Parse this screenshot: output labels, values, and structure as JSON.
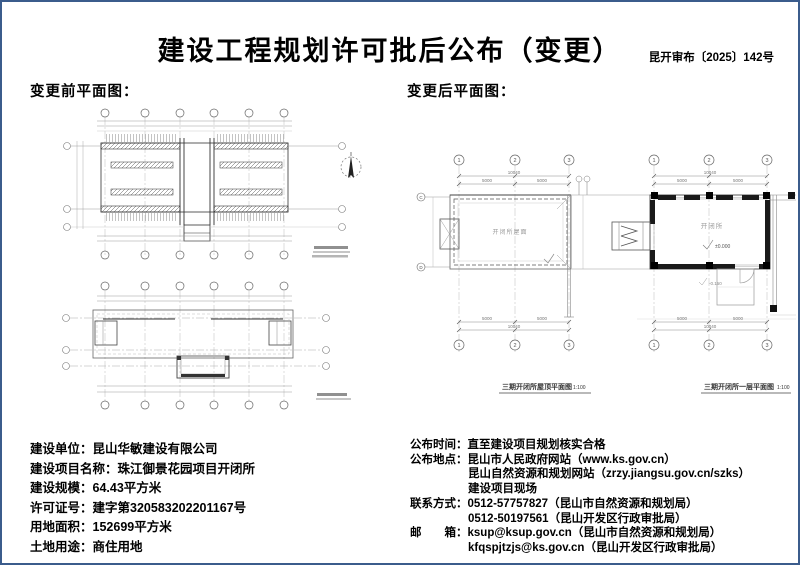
{
  "page": {
    "title": "建设工程规划许可批后公布（变更）",
    "doc_number": "昆开审布〔2025〕142号",
    "border_color": "#3b5c8c"
  },
  "sections": {
    "before_label": "变更前平面图：",
    "after_label": "变更后平面图："
  },
  "after_drawing": {
    "roof_plan": {
      "caption": "三期开闭所屋顶平面图",
      "scale": "1:100",
      "room_label": "开闭所屋面",
      "grid_top": [
        "1",
        "2",
        "3"
      ],
      "grid_left": [
        "C",
        "D"
      ],
      "dim_total": "10040",
      "dim_span1": "5000",
      "dim_span2": "5000"
    },
    "floor_plan": {
      "caption": "三期开闭所一层平面图",
      "scale": "1:100",
      "room_label": "开闭所",
      "level_main": "±0.000",
      "level_out": "-0.150",
      "grid_top": [
        "1",
        "2",
        "3"
      ],
      "dim_total": "10040",
      "dim_span1": "5000",
      "dim_span2": "5000"
    }
  },
  "info_left": {
    "lines": [
      {
        "label": "建设单位：",
        "value": "昆山华敏建设有限公司"
      },
      {
        "label": "建设项目名称：",
        "value": "珠江御景花园项目开闭所"
      },
      {
        "label": "建设规模：",
        "value": "64.43平方米"
      },
      {
        "label": "许可证号：",
        "value": "建字第320583202201167号"
      },
      {
        "label": "用地面积：",
        "value": "152699平方米"
      },
      {
        "label": "土地用途：",
        "value": "商住用地"
      }
    ]
  },
  "info_right": {
    "lines": [
      {
        "label": "公布时间：",
        "value": "直至建设项目规划核实合格"
      },
      {
        "label": "公布地点：",
        "value": "昆山市人民政府网站（www.ks.gov.cn）"
      },
      {
        "label": "",
        "value": "昆山自然资源和规划网站（zrzy.jiangsu.gov.cn/szks）"
      },
      {
        "label": "",
        "value": "建设项目现场"
      },
      {
        "label": "联系方式：",
        "value": "0512-57757827（昆山市自然资源和规划局）"
      },
      {
        "label": "",
        "value": "0512-50197561（昆山开发区行政审批局）"
      },
      {
        "label": "邮　　箱：",
        "value": "ksup@ksup.gov.cn（昆山市自然资源和规划局）"
      },
      {
        "label": "",
        "value": "kfqspjtzjs@ks.gov.cn（昆山开发区行政审批局）"
      }
    ]
  }
}
